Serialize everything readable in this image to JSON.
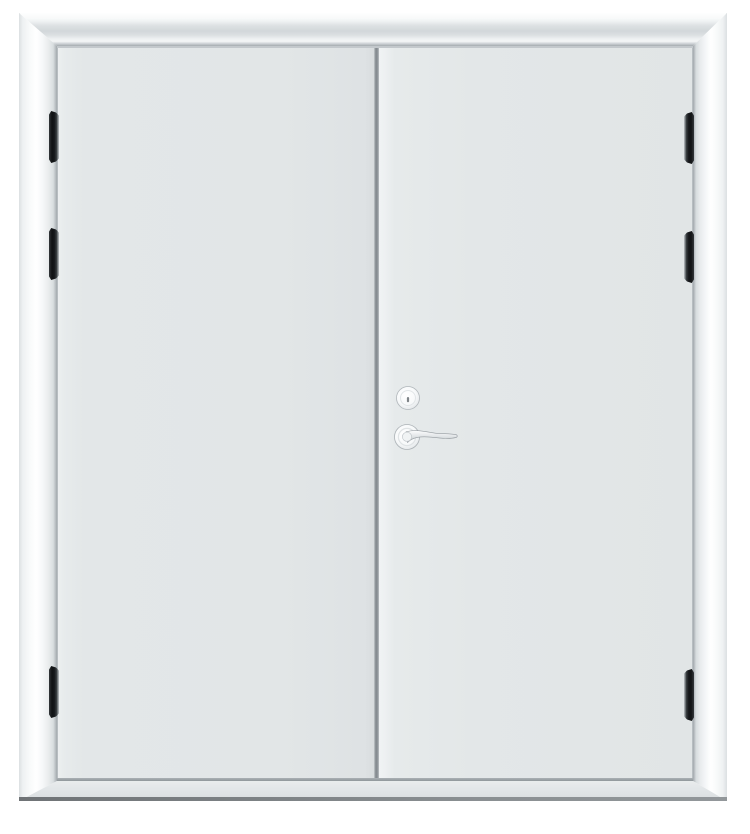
{
  "meta": {
    "description": "Product photograph of a closed white double metal door with mitred frame, six black hinges, a round deadbolt lock and a lever handle on the right leaf",
    "visible_text": ""
  },
  "theme": {
    "page_bg": "#ffffff",
    "frame_outline": "#cbd0d3",
    "frame_bevel": "#d2d7da",
    "door_panel": "#e3e7e8",
    "door_gap": "#83898e",
    "threshold": "#e2e6e8",
    "ground_shadow": "#8a8f92",
    "hinge": "#101214",
    "hardware_stroke": "#b0b6ba",
    "hardware_metal": "#c8cdd1"
  },
  "parts": {
    "frame": "door-frame",
    "head": "frame-head",
    "left_jamb": "frame-left-jamb",
    "right_jamb": "frame-right-jamb",
    "sill": "threshold-sill",
    "left_leaf": "left-door-leaf",
    "right_leaf": "right-door-leaf",
    "gap": "door-meeting-gap",
    "hinges": [
      "hinge-left-top",
      "hinge-left-middle",
      "hinge-left-bottom",
      "hinge-right-top",
      "hinge-right-middle",
      "hinge-right-bottom"
    ],
    "deadbolt": "deadbolt-lock",
    "handle": "lever-handle"
  }
}
